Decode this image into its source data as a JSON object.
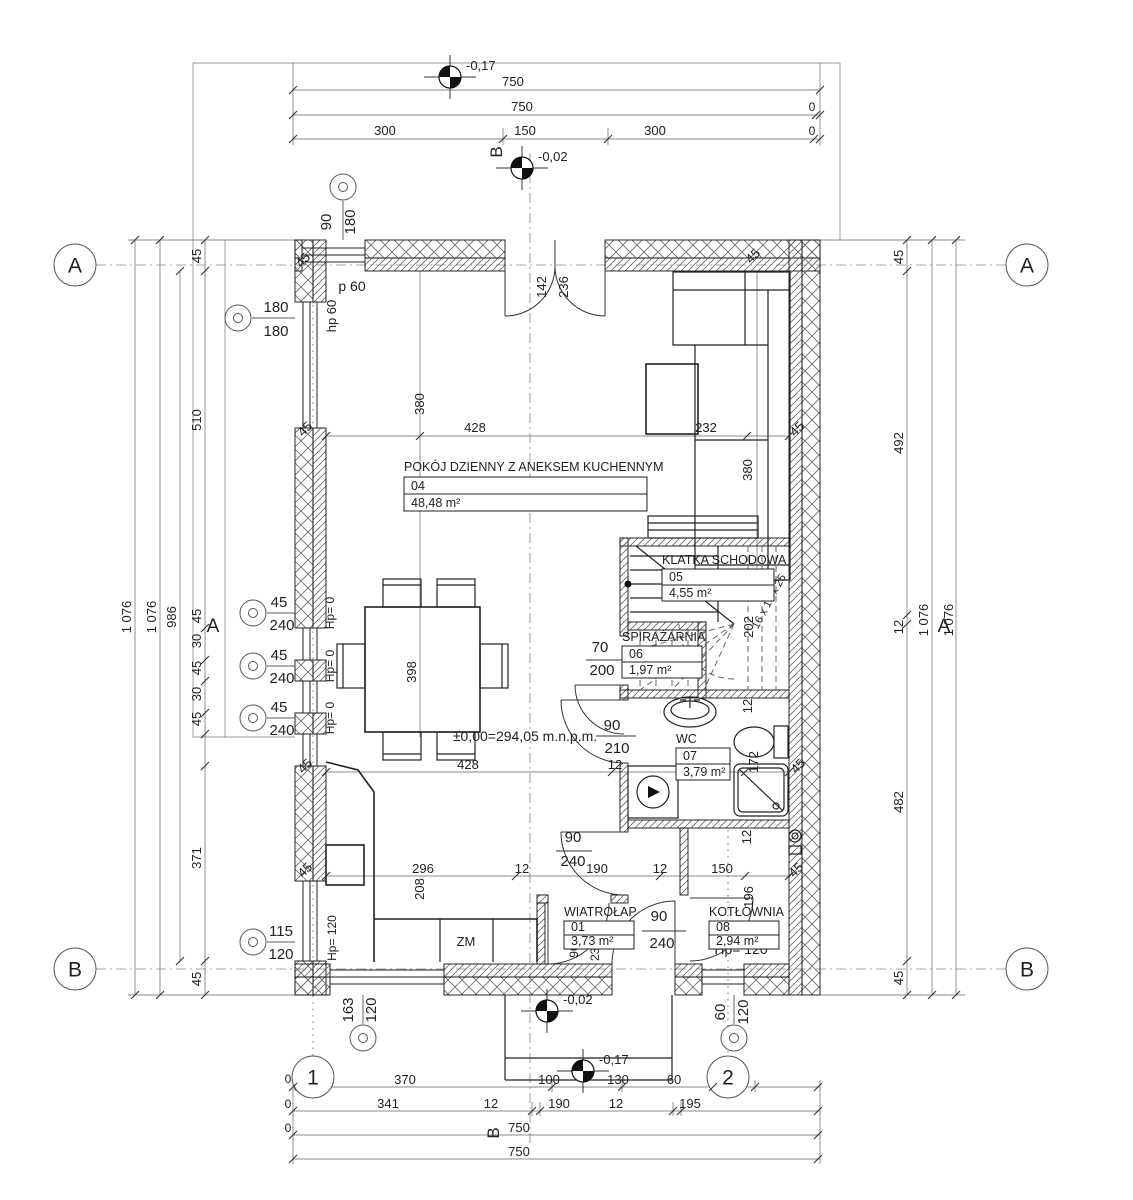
{
  "drawing": {
    "type": "architectural-floor-plan",
    "level_note": "±0,00=294,05 m.n.p.m."
  },
  "rooms": [
    {
      "number": "04",
      "name": "POKÓJ DZIENNY Z ANEKSEM KUCHENNYM",
      "area": "48,48 m²",
      "nx": 404,
      "ny": 471,
      "bx": 404,
      "by": 477,
      "bw": 243,
      "bh": 17
    },
    {
      "number": "05",
      "name": "KLATKA SCHODOWA",
      "area": "4,55 m²",
      "nx": 662,
      "ny": 564,
      "bx": 662,
      "by": 569,
      "bw": 112,
      "bh": 16
    },
    {
      "number": "06",
      "name": "SPIRAŻARNIA",
      "area": "1,97 m²",
      "nx": 622,
      "ny": 641,
      "bx": 622,
      "by": 646,
      "bw": 80,
      "bh": 16
    },
    {
      "number": "07",
      "name": "WC",
      "area": "3,79 m²",
      "nx": 676,
      "ny": 743,
      "bx": 676,
      "by": 748,
      "bw": 54,
      "bh": 16
    },
    {
      "number": "01",
      "name": "WIATROŁAP",
      "area": "3,73 m²",
      "nx": 564,
      "ny": 916,
      "bx": 564,
      "by": 921,
      "bw": 70,
      "bh": 14
    },
    {
      "number": "08",
      "name": "KOTŁOWNIA",
      "area": "2,94 m²",
      "nx": 709,
      "ny": 916,
      "bx": 709,
      "by": 921,
      "bw": 70,
      "bh": 14
    }
  ],
  "axis_markers": [
    {
      "t": "A",
      "x": 75,
      "y": 265
    },
    {
      "t": "A",
      "x": 1027,
      "y": 265
    },
    {
      "t": "B",
      "x": 75,
      "y": 969
    },
    {
      "t": "B",
      "x": 1027,
      "y": 969
    },
    {
      "t": "1",
      "x": 313,
      "y": 1077
    },
    {
      "t": "2",
      "x": 728,
      "y": 1077
    }
  ],
  "window_markers": [
    {
      "w": "90",
      "h": "180",
      "cx": 343,
      "cy": 187,
      "rot": true,
      "tx1": 331,
      "ty1": 222,
      "tx2": 355,
      "ty2": 222,
      "leader": [
        343,
        201,
        343,
        240
      ]
    },
    {
      "w": "180",
      "h": "180",
      "cx": 238,
      "cy": 318,
      "rot": false,
      "tx1": 276,
      "ty1": 312,
      "tx2": 276,
      "ty2": 336,
      "leader": [
        252,
        318,
        295,
        318
      ]
    },
    {
      "w": "45",
      "h": "240",
      "cx": 253,
      "cy": 613,
      "rot": false,
      "tx1": 279,
      "ty1": 607,
      "tx2": 282,
      "ty2": 630,
      "leader": [
        267,
        613,
        295,
        613
      ]
    },
    {
      "w": "45",
      "h": "240",
      "cx": 253,
      "cy": 666,
      "rot": false,
      "tx1": 279,
      "ty1": 660,
      "tx2": 282,
      "ty2": 683,
      "leader": [
        267,
        666,
        295,
        666
      ]
    },
    {
      "w": "45",
      "h": "240",
      "cx": 253,
      "cy": 718,
      "rot": false,
      "tx1": 279,
      "ty1": 712,
      "tx2": 282,
      "ty2": 735,
      "leader": [
        267,
        718,
        295,
        718
      ]
    },
    {
      "w": "115",
      "h": "120",
      "cx": 253,
      "cy": 942,
      "rot": false,
      "tx1": 281,
      "ty1": 936,
      "tx2": 281,
      "ty2": 959,
      "leader": [
        267,
        942,
        295,
        942
      ]
    },
    {
      "w": "163",
      "h": "120",
      "cx": 363,
      "cy": 1038,
      "rot": true,
      "tx1": 353,
      "ty1": 1010,
      "tx2": 376,
      "ty2": 1010,
      "leader": [
        363,
        995,
        363,
        1024
      ]
    },
    {
      "w": "60",
      "h": "120",
      "cx": 734,
      "cy": 1038,
      "rot": true,
      "tx1": 725,
      "ty1": 1012,
      "tx2": 748,
      "ty2": 1012,
      "leader": [
        734,
        995,
        734,
        1024
      ]
    }
  ],
  "elevation_markers": [
    {
      "v": "-0,17",
      "x": 450,
      "y": 77,
      "tx": 466,
      "ty": 70
    },
    {
      "v": "-0,02",
      "x": 522,
      "y": 168,
      "tx": 538,
      "ty": 161
    },
    {
      "v": "-0,02",
      "x": 547,
      "y": 1011,
      "tx": 563,
      "ty": 1004
    },
    {
      "v": "-0,17",
      "x": 583,
      "y": 1071,
      "tx": 599,
      "ty": 1064
    }
  ],
  "labels": [
    {
      "t": "750",
      "x": 513,
      "y": 86
    },
    {
      "t": "750",
      "x": 522,
      "y": 111
    },
    {
      "t": "0",
      "x": 812,
      "y": 111,
      "s": 12
    },
    {
      "t": "300",
      "x": 385,
      "y": 135
    },
    {
      "t": "150",
      "x": 525,
      "y": 135
    },
    {
      "t": "300",
      "x": 655,
      "y": 135
    },
    {
      "t": "0",
      "x": 812,
      "y": 135,
      "s": 12
    },
    {
      "t": "B",
      "x": 502,
      "y": 152,
      "r": -90,
      "s": 17,
      "n": "axis-b-label"
    },
    {
      "t": "B",
      "x": 499,
      "y": 1133,
      "r": -90,
      "s": 17,
      "n": "axis-b-label"
    },
    {
      "t": "1 076",
      "x": 131,
      "y": 617,
      "r": -90
    },
    {
      "t": "1 076",
      "x": 156,
      "y": 617,
      "r": -90
    },
    {
      "t": "986",
      "x": 176,
      "y": 617,
      "r": -90
    },
    {
      "t": "45",
      "x": 201,
      "y": 256,
      "r": -90
    },
    {
      "t": "510",
      "x": 201,
      "y": 420,
      "r": -90
    },
    {
      "t": "45",
      "x": 201,
      "y": 616,
      "r": -90
    },
    {
      "t": "30",
      "x": 201,
      "y": 641,
      "r": -90
    },
    {
      "t": "45",
      "x": 201,
      "y": 668,
      "r": -90
    },
    {
      "t": "30",
      "x": 201,
      "y": 694,
      "r": -90
    },
    {
      "t": "45",
      "x": 201,
      "y": 719,
      "r": -90
    },
    {
      "t": "371",
      "x": 201,
      "y": 858,
      "r": -90
    },
    {
      "t": "45",
      "x": 201,
      "y": 979,
      "r": -90
    },
    {
      "t": "45",
      "x": 903,
      "y": 257,
      "r": -90
    },
    {
      "t": "492",
      "x": 903,
      "y": 443,
      "r": -90
    },
    {
      "t": "12",
      "x": 903,
      "y": 627,
      "r": -90
    },
    {
      "t": "482",
      "x": 903,
      "y": 802,
      "r": -90
    },
    {
      "t": "45",
      "x": 903,
      "y": 978,
      "r": -90
    },
    {
      "t": "1 076",
      "x": 928,
      "y": 620,
      "r": -90
    },
    {
      "t": "1 076",
      "x": 953,
      "y": 620,
      "r": -90
    },
    {
      "t": "A",
      "x": 213,
      "y": 632,
      "s": 19,
      "n": "axis-section-label"
    },
    {
      "t": "A",
      "x": 944,
      "y": 632,
      "s": 19,
      "n": "axis-section-label"
    },
    {
      "t": "0",
      "x": 288,
      "y": 1083,
      "s": 12
    },
    {
      "t": "0",
      "x": 297,
      "y": 1091,
      "s": 12
    },
    {
      "t": "370",
      "x": 405,
      "y": 1084
    },
    {
      "t": "100",
      "x": 549,
      "y": 1084
    },
    {
      "t": "130",
      "x": 618,
      "y": 1084
    },
    {
      "t": "60",
      "x": 674,
      "y": 1084
    },
    {
      "t": "90",
      "x": 722,
      "y": 1086
    },
    {
      "t": "0",
      "x": 288,
      "y": 1108,
      "s": 12
    },
    {
      "t": "341",
      "x": 388,
      "y": 1108
    },
    {
      "t": "12",
      "x": 491,
      "y": 1108
    },
    {
      "t": "190",
      "x": 559,
      "y": 1108
    },
    {
      "t": "12",
      "x": 616,
      "y": 1108
    },
    {
      "t": "195",
      "x": 690,
      "y": 1108
    },
    {
      "t": "0",
      "x": 288,
      "y": 1132,
      "s": 12
    },
    {
      "t": "750",
      "x": 519,
      "y": 1132
    },
    {
      "t": "750",
      "x": 519,
      "y": 1156
    },
    {
      "t": "45",
      "x": 306,
      "y": 263,
      "r": -45
    },
    {
      "t": "45",
      "x": 756,
      "y": 259,
      "r": -45
    },
    {
      "t": "142",
      "x": 546,
      "y": 287,
      "r": -90
    },
    {
      "t": "236",
      "x": 568,
      "y": 287,
      "r": -90
    },
    {
      "t": "380",
      "x": 424,
      "y": 404,
      "r": -90
    },
    {
      "t": "380",
      "x": 752,
      "y": 470,
      "r": -90
    },
    {
      "t": "45",
      "x": 308,
      "y": 432,
      "r": -45
    },
    {
      "t": "428",
      "x": 475,
      "y": 432
    },
    {
      "t": "232",
      "x": 706,
      "y": 432
    },
    {
      "t": "45",
      "x": 800,
      "y": 432,
      "r": -45
    },
    {
      "t": "398",
      "x": 416,
      "y": 672,
      "r": -90
    },
    {
      "t": "±0,00=294,05 m.n.p.m.",
      "x": 525,
      "y": 741,
      "s": 14,
      "n": "elevation-note"
    },
    {
      "t": "p 60",
      "x": 352,
      "y": 291,
      "s": 14,
      "n": "sill-height-label"
    },
    {
      "t": "hp 60",
      "x": 336,
      "y": 316,
      "r": -90,
      "s": 13,
      "n": "sill-height-label"
    },
    {
      "t": "Hp= 0",
      "x": 334,
      "y": 613,
      "r": -90,
      "s": 12,
      "n": "sill-height-label"
    },
    {
      "t": "Hp= 0",
      "x": 334,
      "y": 666,
      "r": -90,
      "s": 12,
      "n": "sill-height-label"
    },
    {
      "t": "Hp= 0",
      "x": 334,
      "y": 718,
      "r": -90,
      "s": 12,
      "n": "sill-height-label"
    },
    {
      "t": "Hp= 120",
      "x": 336,
      "y": 938,
      "r": -90,
      "s": 12,
      "n": "sill-height-label"
    },
    {
      "t": "Hp= 120",
      "x": 741,
      "y": 954,
      "s": 14,
      "n": "sill-height-label"
    },
    {
      "t": "ZM",
      "x": 466,
      "y": 946,
      "s": 13,
      "n": "kitchen-appliance-label"
    },
    {
      "t": "202",
      "x": 753,
      "y": 627,
      "r": -90,
      "n": "stair-dimension"
    },
    {
      "t": "16 x 19 x 25",
      "x": 772,
      "y": 603,
      "r": -62,
      "s": 11,
      "n": "stair-note"
    },
    {
      "t": "90",
      "x": 612,
      "y": 730,
      "s": 15,
      "n": "door-size-label"
    },
    {
      "t": "210",
      "x": 617,
      "y": 753,
      "s": 15,
      "n": "door-size-label"
    },
    {
      "t": "70",
      "x": 600,
      "y": 652,
      "s": 15,
      "n": "door-size-label"
    },
    {
      "t": "200",
      "x": 602,
      "y": 675,
      "s": 15,
      "n": "door-size-label"
    },
    {
      "t": "90",
      "x": 659,
      "y": 921,
      "s": 15,
      "n": "door-size-label"
    },
    {
      "t": "240",
      "x": 662,
      "y": 948,
      "s": 15,
      "n": "door-size-label"
    },
    {
      "t": "90",
      "x": 573,
      "y": 842,
      "s": 15,
      "n": "door-size-label"
    },
    {
      "t": "240",
      "x": 573,
      "y": 866,
      "s": 15,
      "n": "door-size-label"
    },
    {
      "t": "90",
      "x": 578,
      "y": 951,
      "r": -90,
      "s": 12,
      "n": "door-size-label"
    },
    {
      "t": "235",
      "x": 599,
      "y": 951,
      "r": -90,
      "s": 12,
      "n": "door-size-label"
    },
    {
      "t": "45",
      "x": 308,
      "y": 769,
      "r": -45
    },
    {
      "t": "428",
      "x": 468,
      "y": 769
    },
    {
      "t": "12",
      "x": 615,
      "y": 769
    },
    {
      "t": "220",
      "x": 700,
      "y": 772
    },
    {
      "t": "172",
      "x": 758,
      "y": 762,
      "r": -90
    },
    {
      "t": "12",
      "x": 752,
      "y": 706,
      "r": -90
    },
    {
      "t": "45",
      "x": 801,
      "y": 769,
      "r": -45
    },
    {
      "t": "12",
      "x": 751,
      "y": 837,
      "r": -90
    },
    {
      "t": "45",
      "x": 308,
      "y": 873,
      "r": -45
    },
    {
      "t": "296",
      "x": 423,
      "y": 873
    },
    {
      "t": "208",
      "x": 424,
      "y": 889,
      "r": -90
    },
    {
      "t": "12",
      "x": 522,
      "y": 873
    },
    {
      "t": "190",
      "x": 597,
      "y": 873
    },
    {
      "t": "12",
      "x": 660,
      "y": 873
    },
    {
      "t": "150",
      "x": 722,
      "y": 873
    },
    {
      "t": "196",
      "x": 753,
      "y": 897,
      "r": -90
    },
    {
      "t": "45",
      "x": 799,
      "y": 873,
      "r": -45
    }
  ]
}
